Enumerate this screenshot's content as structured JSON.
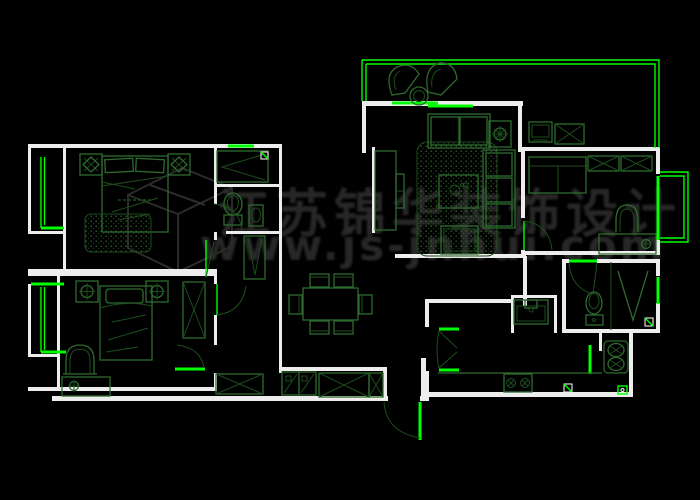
{
  "watermark": {
    "brand_text": "江苏锦华装饰设计",
    "url": "www.js-jnhui.com"
  },
  "colors": {
    "background": "#000000",
    "wall": "#ededed",
    "furniture": "#2e6b2e",
    "furniture_dim": "#1d4d1d",
    "accent": "#00ff00",
    "watermark_text": "#2b2b2b"
  },
  "plan": {
    "rooms": [
      "master-bedroom",
      "ensuite-closet-bath",
      "second-bedroom",
      "corridor",
      "dining-room",
      "living-room",
      "balcony",
      "study",
      "bathroom",
      "kitchen",
      "laundry",
      "entry"
    ],
    "furniture_symbols": [
      "double-bed",
      "single-bed",
      "nightstand-lamp",
      "rug",
      "wardrobe-x",
      "wardrobe-v",
      "armchair",
      "desk-lamp",
      "dining-table-six-chairs",
      "two-seat-sofa",
      "three-seat-sofa",
      "ottoman",
      "coffee-table",
      "corner-table-lamp",
      "tv-cabinet",
      "fan-chair",
      "round-table",
      "daybed",
      "wall-cabinet-x",
      "monitor",
      "toilet",
      "shower-mark",
      "washbasin",
      "double-basin-sink",
      "kitchen-sink",
      "gas-stove",
      "folding-door",
      "shoe-cabinet",
      "floor-drain",
      "bay-window",
      "sliding-window",
      "door-arc"
    ]
  }
}
